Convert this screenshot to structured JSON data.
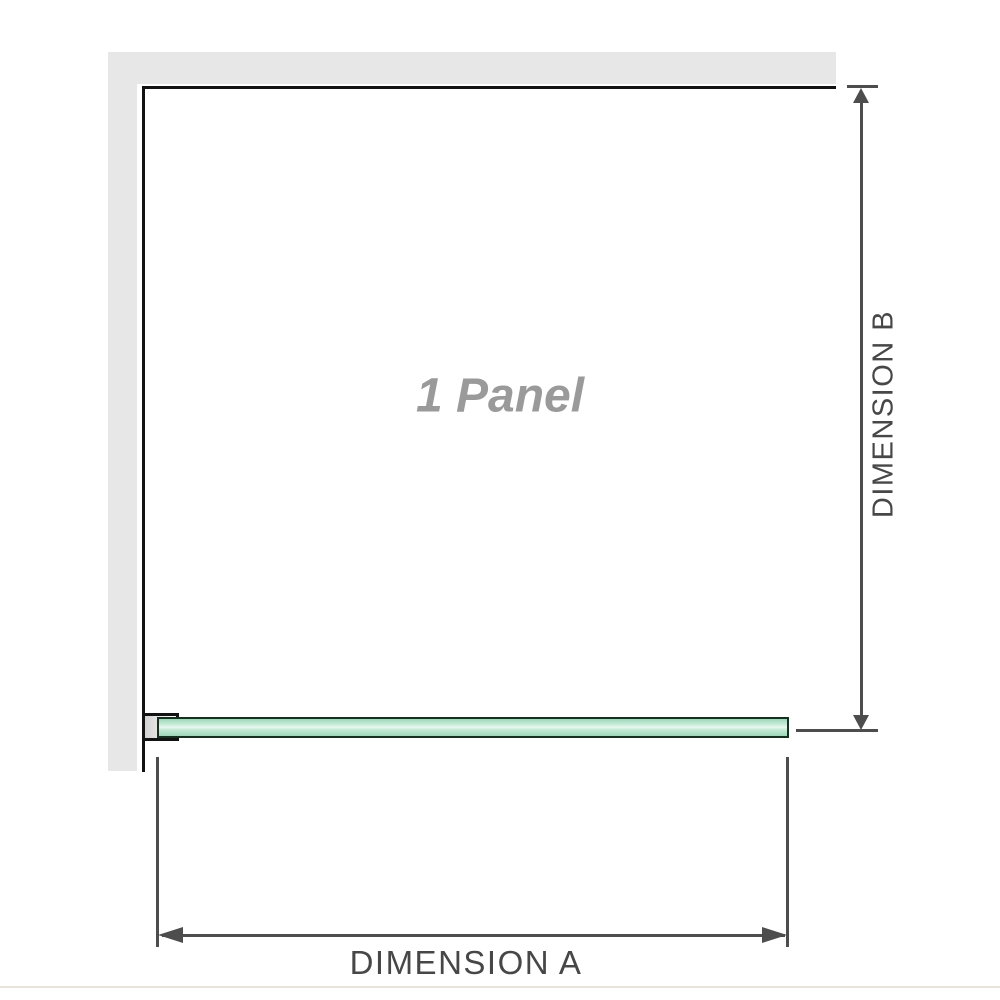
{
  "diagram": {
    "panel_label": "1 Panel",
    "dimensions": {
      "a_label": "DIMENSION A",
      "b_label": "DIMENSION B"
    }
  },
  "colors": {
    "wall": "#e7e7e7",
    "outline": "#121212",
    "dimension_line": "#4d4d4d",
    "label_text": "#474747",
    "panel_text": "#9a9a9a",
    "glass_edge": "#16301f",
    "glass_green": "#9fd7ba",
    "glass_green_light": "#c3e9d4",
    "glass_highlight": "#e9f8f0",
    "bracket_fill_start": "#d2d2d2",
    "bracket_fill_end": "#ffffff",
    "baseline": "#e8e4dc"
  }
}
